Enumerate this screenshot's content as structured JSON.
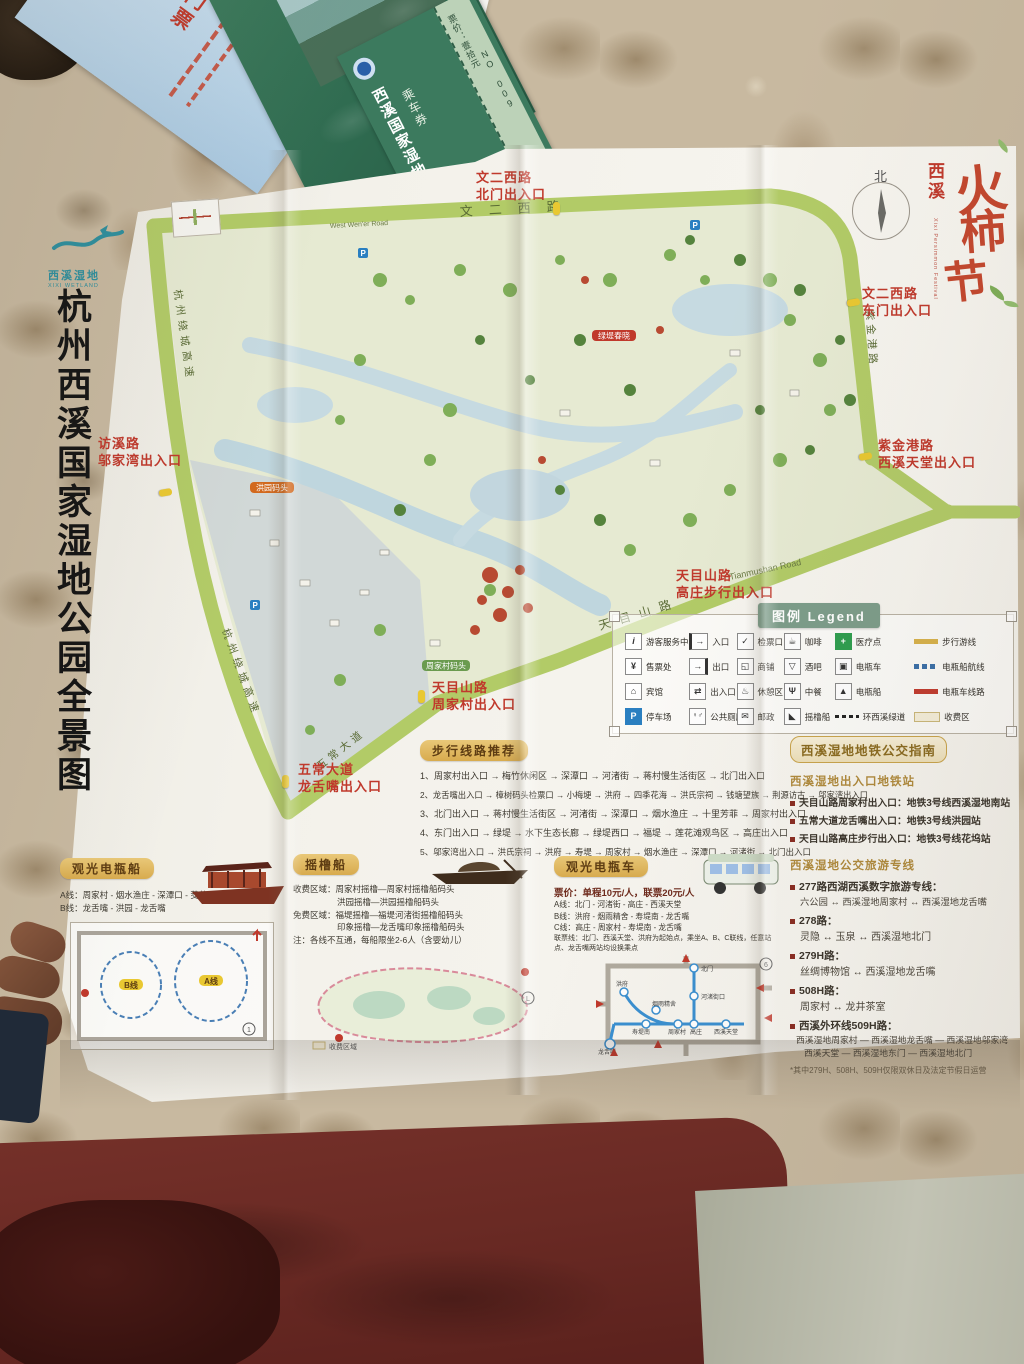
{
  "tickets": {
    "blue_ticket_label": "门票",
    "green_brochure_title": "西溪国家湿地公园",
    "green_brochure_sub": "乘车券",
    "green_brochure_price": "票价：壹拾元",
    "green_brochure_no": "NO 009",
    "green_card_label": "乘车券"
  },
  "map": {
    "title": "杭州西溪国家湿地公园全景图",
    "logo_name": "西溪湿地",
    "logo_en": "XIXI WETLAND",
    "festival": {
      "prefix": "西溪",
      "c1": "火",
      "c2": "柿",
      "c3": "节",
      "en": "Xixi Persimmon Festival"
    },
    "compass": "北",
    "roads": {
      "wener_west": "文二西路",
      "wener_west_en": "West Wen'er Road",
      "ring_expwy": "杭州绕城高速",
      "zijingang": "紫金港路",
      "tianmushan": "天目山路",
      "tianmushan_en": "Tianmushan Road",
      "wuchang": "五常大道"
    },
    "entrances": {
      "north1": "文二西路",
      "north2": "北门出入口",
      "east1": "文二西路",
      "east2": "东门出入口",
      "paradise1": "紫金港路",
      "paradise2": "西溪天堂出入口",
      "gaozhuang1": "天目山路",
      "gaozhuang2": "高庄步行出入口",
      "zhoujiacun1": "天目山路",
      "zhoujiacun2": "周家村出入口",
      "longshezui1": "五常大道",
      "longshezui2": "龙舌嘴出入口",
      "wujiawan1": "访溪路",
      "wujiawan2": "邬家湾出入口"
    },
    "badges": {
      "b1": "洪园码头",
      "b2": "绿堤春晓",
      "b3": "周家村码头"
    }
  },
  "legend": {
    "title": "图例 Legend",
    "items": [
      {
        "label": "游客服务中心"
      },
      {
        "label": "入口"
      },
      {
        "label": "检票口"
      },
      {
        "label": "咖啡"
      },
      {
        "label": "医疗点"
      },
      {
        "label": "步行游线"
      },
      {
        "label": "售票处"
      },
      {
        "label": "出口"
      },
      {
        "label": "商铺"
      },
      {
        "label": "酒吧"
      },
      {
        "label": "电瓶车"
      },
      {
        "label": "电瓶船航线"
      },
      {
        "label": "宾馆"
      },
      {
        "label": "出入口"
      },
      {
        "label": "休憩区"
      },
      {
        "label": "中餐"
      },
      {
        "label": "电瓶船"
      },
      {
        "label": "电瓶车线路"
      },
      {
        "label": "停车场"
      },
      {
        "label": "公共厕所"
      },
      {
        "label": "邮政"
      },
      {
        "label": "摇橹船"
      },
      {
        "label": "环西溪绿道"
      },
      {
        "label": "收费区"
      }
    ]
  },
  "walking": {
    "title": "步行线路推荐",
    "routes": [
      "1、周家村出入口 → 梅竹休闲区 → 深潭口 → 河渚街 → 蒋村慢生活街区 → 北门出入口",
      "2、龙舌嘴出入口 → 樟树码头检票口 → 小梅埂 → 洪府 → 四季花海 → 洪氏宗祠 → 钱塘望族 → 荆源访古 → 邬家湾出入口",
      "3、北门出入口 → 蒋村慢生活街区 → 河渚街 → 深潭口 → 烟水渔庄 → 十里芳菲 → 周家村出入口",
      "4、东门出入口 → 绿堤 → 水下生态长廊 → 绿堤西口 → 福堤 → 莲花滩观鸟区 → 高庄出入口",
      "5、邬家湾出入口 → 洪氏宗祠 → 洪府 → 寿堤 → 周家村 → 烟水渔庄 → 深潭口 → 河渚街 → 北门出入口"
    ]
  },
  "boat": {
    "title": "观光电瓶船",
    "line_a": "A线：周家村 - 烟水渔庄 - 深潭口 - 茭芦田庄 - 周家村",
    "line_b": "B线：龙舌嘴 - 洪园 - 龙舌嘴",
    "diag_a": "A线",
    "diag_b": "B线"
  },
  "rowing": {
    "title": "摇橹船",
    "paid1": "收费区域：周家村摇橹—周家村摇橹船码头",
    "paid2": "洪园摇橹—洪园摇橹船码头",
    "free1": "免费区域：福堤摇橹—福堤河渚街摇橹船码头",
    "free2": "印象摇橹—龙舌嘴印象摇橹船码头",
    "note": "注：各线不互通，每船限坐2-6人（含婴幼儿）",
    "diag_note": "收费区域"
  },
  "cart": {
    "title": "观光电瓶车",
    "fare": "票价：单程10元/人，联票20元/人",
    "line_a": "A线：北门 - 河渚街 - 高庄 - 西溪天堂",
    "line_b": "B线：洪府 - 烟雨精舍 - 寿堤南 - 龙舌嘴",
    "line_c": "C线：高庄 - 周家村 - 寿堤南 - 龙舌嘴",
    "joint": "联票线：北门、西溪天堂、洪府为起始点，乘坐A、B、C联线，任意站点、龙舌嘴两站均设换乘点",
    "stops": {
      "beimen": "北门",
      "hezhujie": "河渚街口",
      "hongfu": "洪府",
      "yanyu": "烟雨精舍",
      "shoutinan": "寿堤南",
      "zhoujiacun": "周家村",
      "gaozhuang": "高庄",
      "paradise": "西溪天堂",
      "longshezui": "龙舌嘴"
    }
  },
  "transit": {
    "title": "西溪湿地地铁公交指南",
    "metro_title": "西溪湿地出入口地铁站",
    "metro1": "天目山路周家村出入口：地铁3号线西溪湿地南站",
    "metro2": "五常大道龙舌嘴出入口：地铁3号线洪园站",
    "metro3": "天目山路高庄步行出入口：地铁3号线花坞站",
    "bus_title": "西溪湿地公交旅游专线",
    "b277_head": "277路西湖西溪数字旅游专线：",
    "b277_body": "六公园 ↔ 西溪湿地周家村 ↔ 西溪湿地龙舌嘴",
    "b278_head": "278路：",
    "b278_body": "灵隐 ↔ 玉泉 ↔ 西溪湿地北门",
    "b279_head": "279H路：",
    "b279_body": "丝绸博物馆 ↔ 西溪湿地龙舌嘴",
    "b508_head": "508H路：",
    "b508_body": "周家村 ↔ 龙井茶室",
    "b509_head": "西溪外环线509H路：",
    "b509_body1": "西溪湿地周家村 — 西溪湿地龙舌嘴 — 西溪湿地邬家湾",
    "b509_body2": "西溪天堂 — 西溪湿地东门 — 西溪湿地北门",
    "footnote": "*其中279H、508H、509H仅限双休日及法定节假日运营"
  }
}
